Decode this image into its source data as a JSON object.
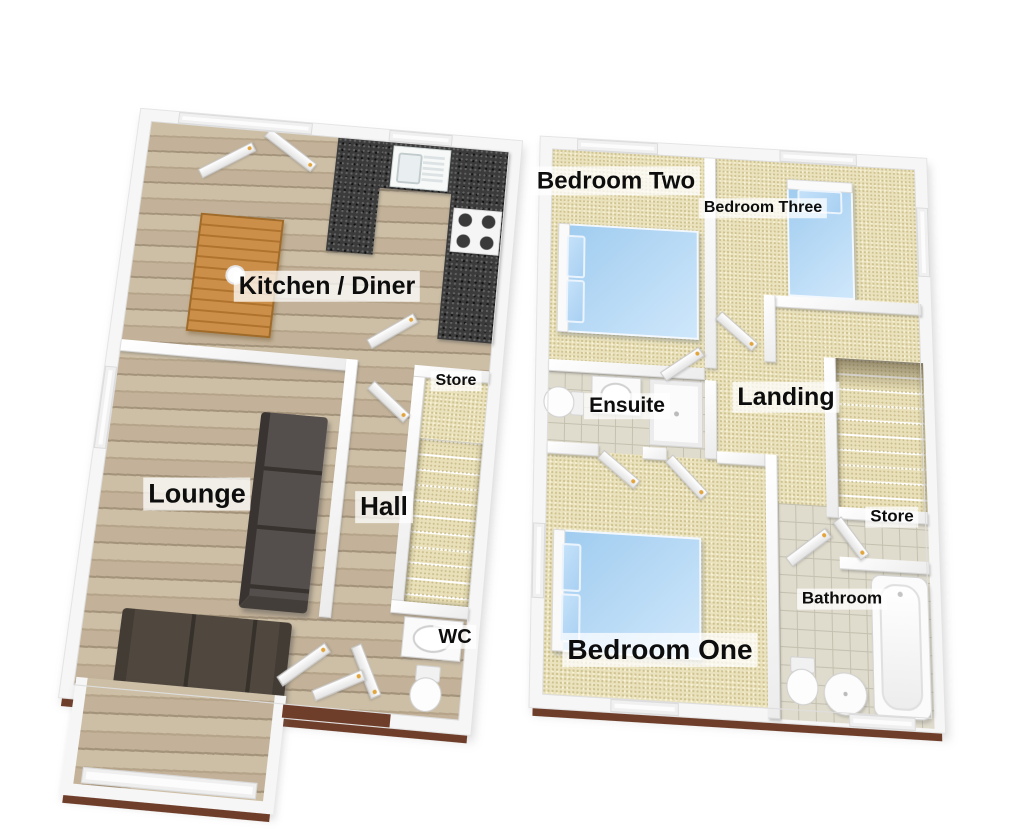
{
  "floorplan": {
    "ground_floor": {
      "rooms": {
        "kitchen_diner": "Kitchen / Diner",
        "store": "Store",
        "lounge": "Lounge",
        "hall": "Hall",
        "wc": "WC"
      }
    },
    "first_floor": {
      "rooms": {
        "bedroom_two": "Bedroom Two",
        "bedroom_three": "Bedroom Three",
        "ensuite": "Ensuite",
        "landing": "Landing",
        "store": "Store",
        "bedroom_one": "Bedroom One",
        "bathroom": "Bathroom"
      }
    },
    "colors": {
      "background": "#ffffff",
      "wall": "#f6f6f6",
      "wall_shade": "#d9d9d9",
      "slab_edge": "#6f3e2b",
      "wood_floor": "#c6b89f",
      "carpet": "#eae2bd",
      "tile": "#e0dccd",
      "granite_worktop": "#3b3b3b",
      "bed_blue": "#a9d2f1",
      "sofa_dark": "#4a4340",
      "table_wood": "#c68a45",
      "door_handle_gold": "#e2a43c"
    }
  }
}
